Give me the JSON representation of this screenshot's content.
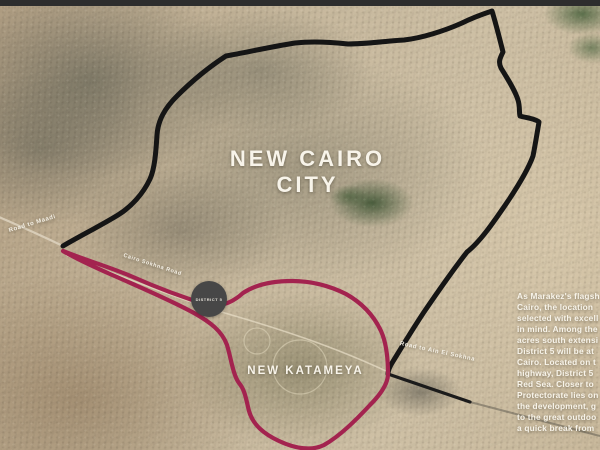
{
  "map": {
    "title_line1": "NEW CAIRO",
    "title_line2": "CITY",
    "area_label": "NEW KATAMEYA",
    "logo_label": "DISTRICT 5",
    "road_labels": {
      "maadi": "Road to Maadi",
      "sokhna_road": "Cairo Sokhna Road",
      "ain_sokhna": "Road to Ain El Sokhna"
    }
  },
  "description": {
    "lines": [
      "As Marakez's flagsh",
      "Cairo, the location",
      "selected with excell",
      "in mind. Among the",
      "acres south extensi",
      "District 5 will be at",
      "Cairo. Located on t",
      "highway, District 5",
      "Red Sea. Closer to",
      "Protectorate lies on",
      "the development, g",
      "to the great outdoo",
      "a quick break from"
    ]
  },
  "colors": {
    "boundary_black": "#151515",
    "boundary_magenta": "#a3234f",
    "label_white": "#f8f4ea",
    "sand": "#c6b79c"
  }
}
